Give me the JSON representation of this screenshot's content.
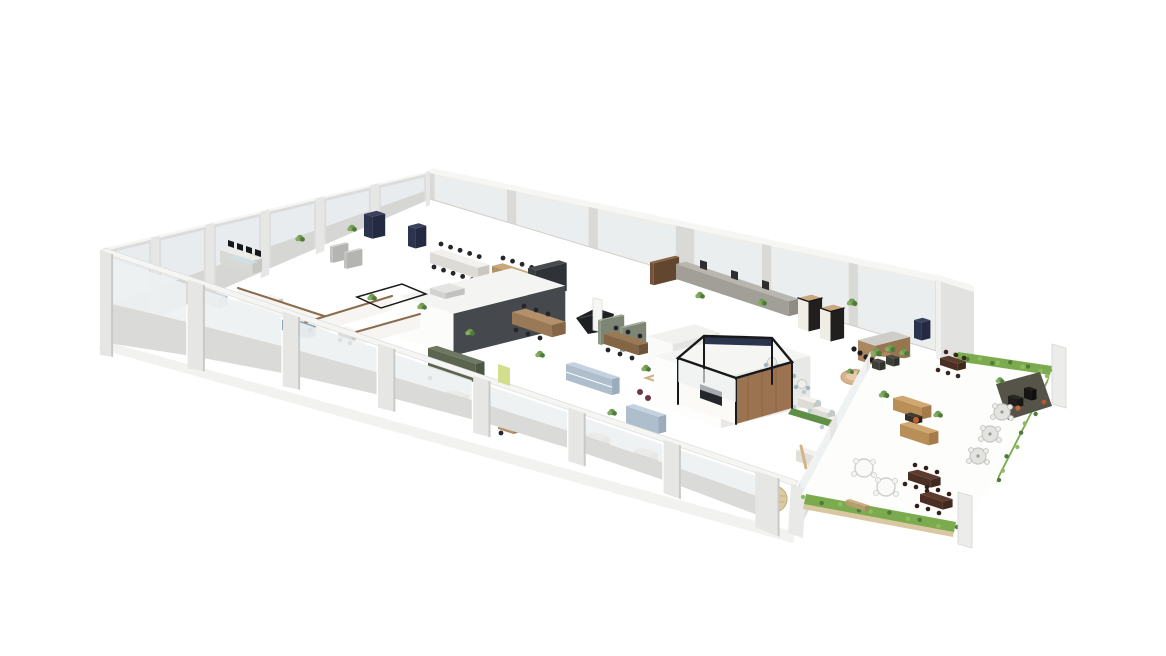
{
  "scene": {
    "title": "3D cutaway floor plan of an office with outdoor terrace",
    "background": "#ffffff"
  },
  "palette": {
    "wallFace": "#dcdcdc",
    "wallLight": "#e6e6e4",
    "wallTop": "#f5f5f3",
    "wallShade": "#c9c9c7",
    "wallInner": "#ededeb",
    "glass": "#eef1f2",
    "glassCool": "#e8ecee",
    "spandrel": "#dadad8",
    "shadow": "#f2f2f0",
    "coreTop": "#f4f4f2",
    "coreFront": "#fcfcfb",
    "charcoal": "#45494d",
    "black": "#17181a",
    "navy": "#2c344d",
    "wood": "#9c7350",
    "woodLight": "#c8a878",
    "woodDark": "#7a5a3e",
    "tan": "#d6ba8e",
    "olive": "#6d7762",
    "plant": "#6f9b53",
    "plantDark": "#4e7a3a",
    "hedge": "#7bab4e",
    "tableBrown": "#5e3b2f",
    "tableBrownDark": "#46291f",
    "orange": "#c4683a",
    "blueShelf": "#c4d1de",
    "teal": "#9db6c0",
    "chairDark": "#26262a",
    "sofaLight": "#f1f0ec",
    "sofaGray": "#d4d7d9",
    "slateBlue": "#8fa3b8",
    "burgundy": "#6e3642",
    "blush": "#e9c9ab",
    "yellowGreen": "#cdd97a",
    "wicker": "#dbc9a2"
  },
  "regions": [
    {
      "id": "open-office",
      "label": "Open office workstations"
    },
    {
      "id": "meeting-room-glass",
      "label": "Black framed glass meeting room"
    },
    {
      "id": "phone-booths",
      "label": "Phone booths"
    },
    {
      "id": "kitchen",
      "label": "Kitchen and island bar"
    },
    {
      "id": "canteen",
      "label": "Canteen seating"
    },
    {
      "id": "core-a",
      "label": "Service core A"
    },
    {
      "id": "core-b",
      "label": "Service core B"
    },
    {
      "id": "terrace",
      "label": "Outdoor terrace"
    },
    {
      "id": "terrace-dining",
      "label": "Terrace dining tables"
    },
    {
      "id": "terrace-lounge",
      "label": "Outdoor lounge"
    }
  ]
}
